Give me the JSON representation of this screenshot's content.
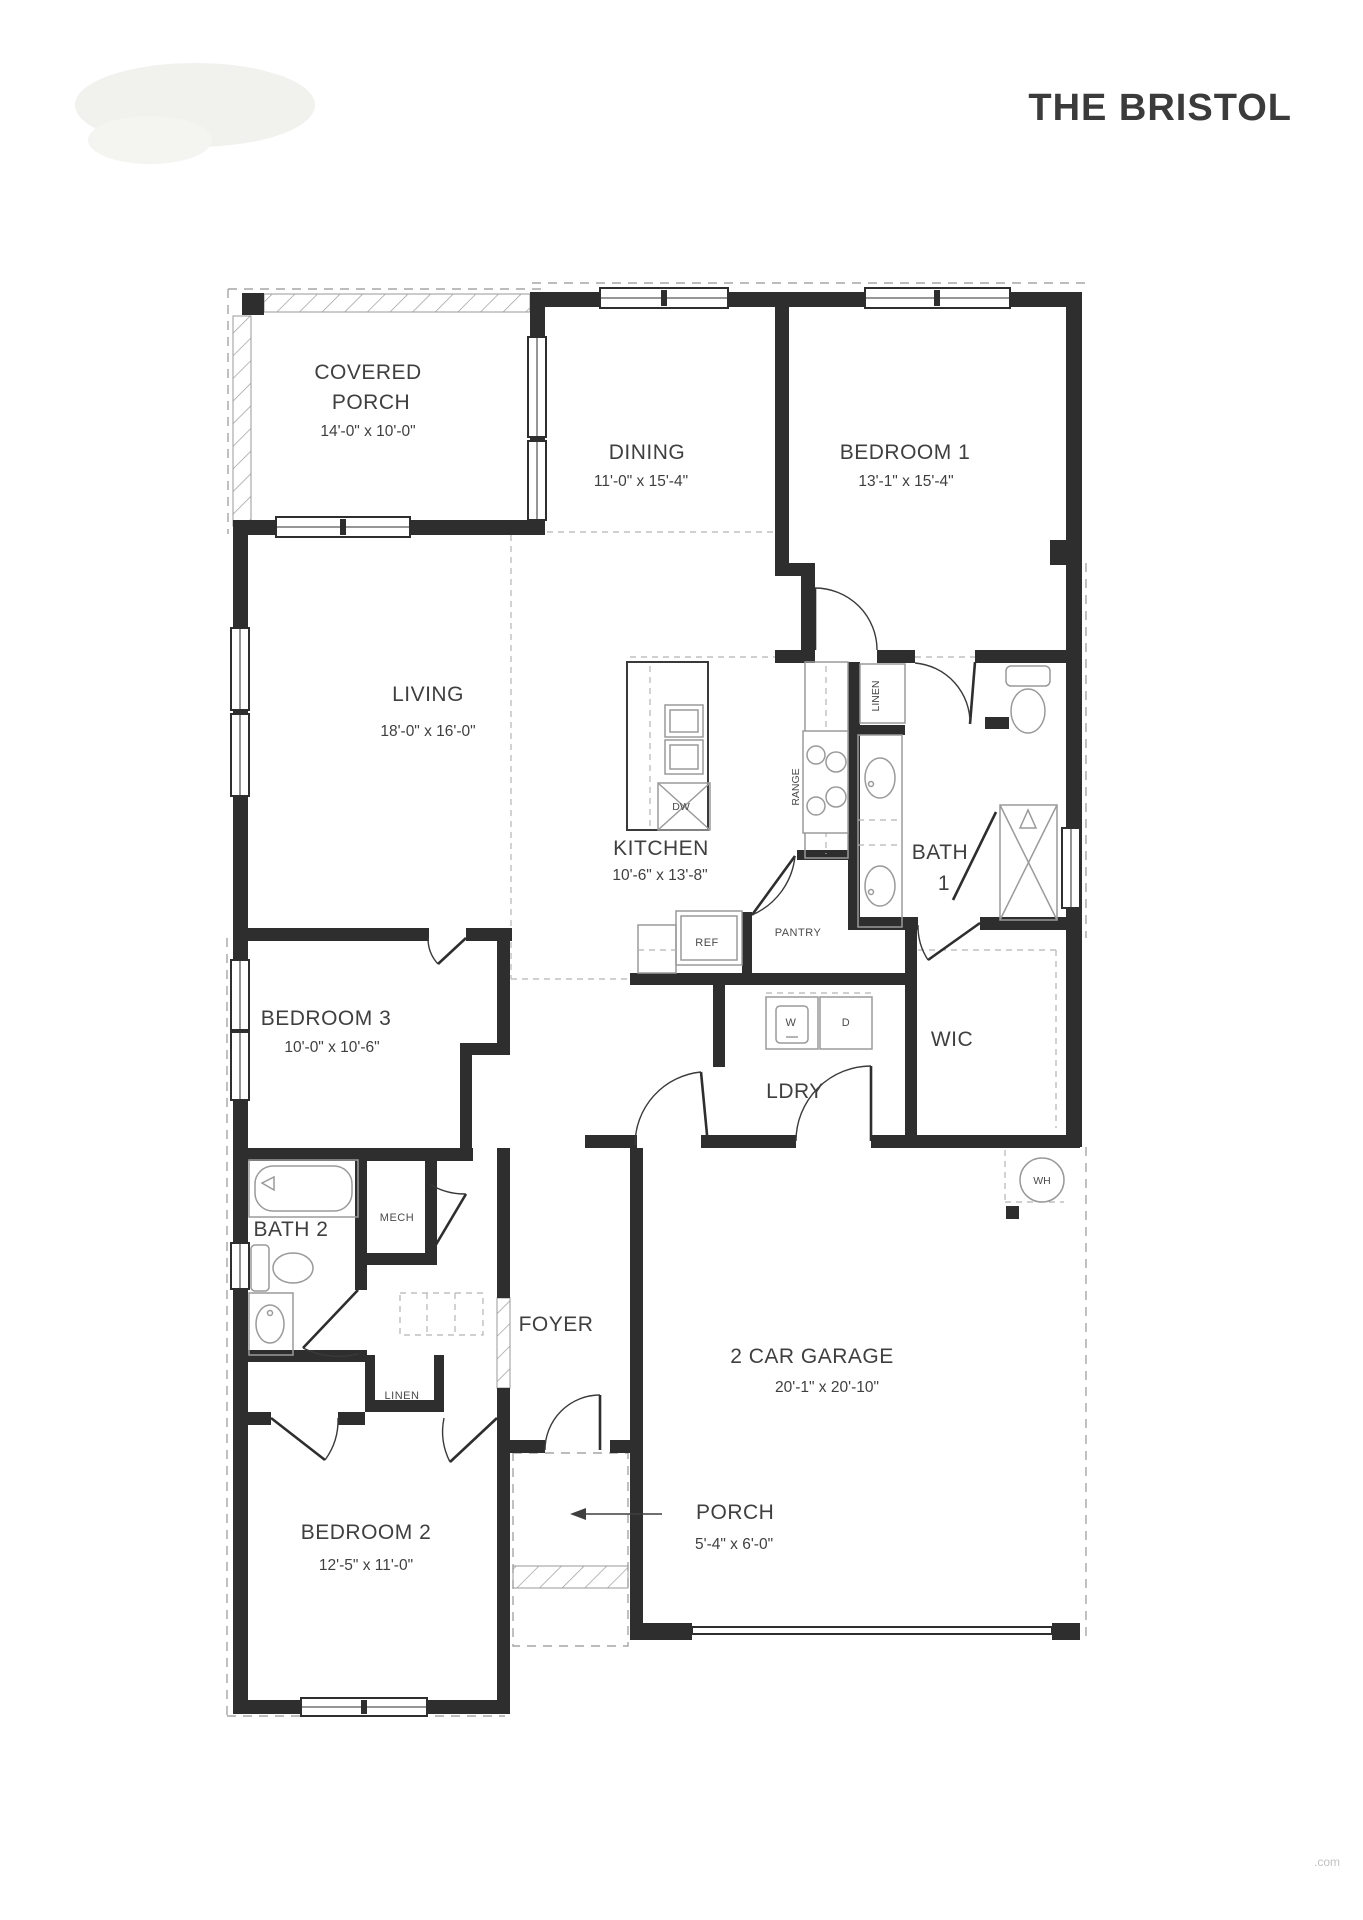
{
  "title": "THE BRISTOL",
  "watermark": ".com",
  "colors": {
    "wall": "#2e2e2e",
    "fixture_line": "#9a9a9a",
    "label_text": "#3f3f3f",
    "background": "#ffffff"
  },
  "rooms": {
    "covered_porch": {
      "name_line1": "COVERED",
      "name_line2": "PORCH",
      "dims": "14'-0\" x 10'-0\""
    },
    "dining": {
      "name": "DINING",
      "dims": "11'-0\" x 15'-4\""
    },
    "bedroom1": {
      "name": "BEDROOM 1",
      "dims": "13'-1\" x 15'-4\""
    },
    "living": {
      "name": "LIVING",
      "dims": "18'-0\" x 16'-0\""
    },
    "kitchen": {
      "name": "KITCHEN",
      "dims": "10'-6\" x 13'-8\""
    },
    "bath1": {
      "name_line1": "BATH",
      "name_line2": "1"
    },
    "wic": {
      "name": "WIC"
    },
    "ldry": {
      "name": "LDRY"
    },
    "bedroom3": {
      "name": "BEDROOM 3",
      "dims": "10'-0\" x 10'-6\""
    },
    "bath2": {
      "name": "BATH 2"
    },
    "mech": {
      "name": "MECH"
    },
    "foyer": {
      "name": "FOYER"
    },
    "garage": {
      "name": "2 CAR GARAGE",
      "dims": "20'-1\" x 20'-10\""
    },
    "bedroom2": {
      "name": "BEDROOM 2",
      "dims": "12'-5\" x 11'-0\""
    },
    "porch": {
      "name": "PORCH",
      "dims": "5'-4\" x 6'-0\""
    }
  },
  "fixtures": {
    "range": "RANGE",
    "linen_bath1": "LINEN",
    "linen_hall": "LINEN",
    "pantry": "PANTRY",
    "ref": "REF",
    "dw": "DW",
    "washer": "W",
    "dryer": "D",
    "water_heater": "WH"
  }
}
